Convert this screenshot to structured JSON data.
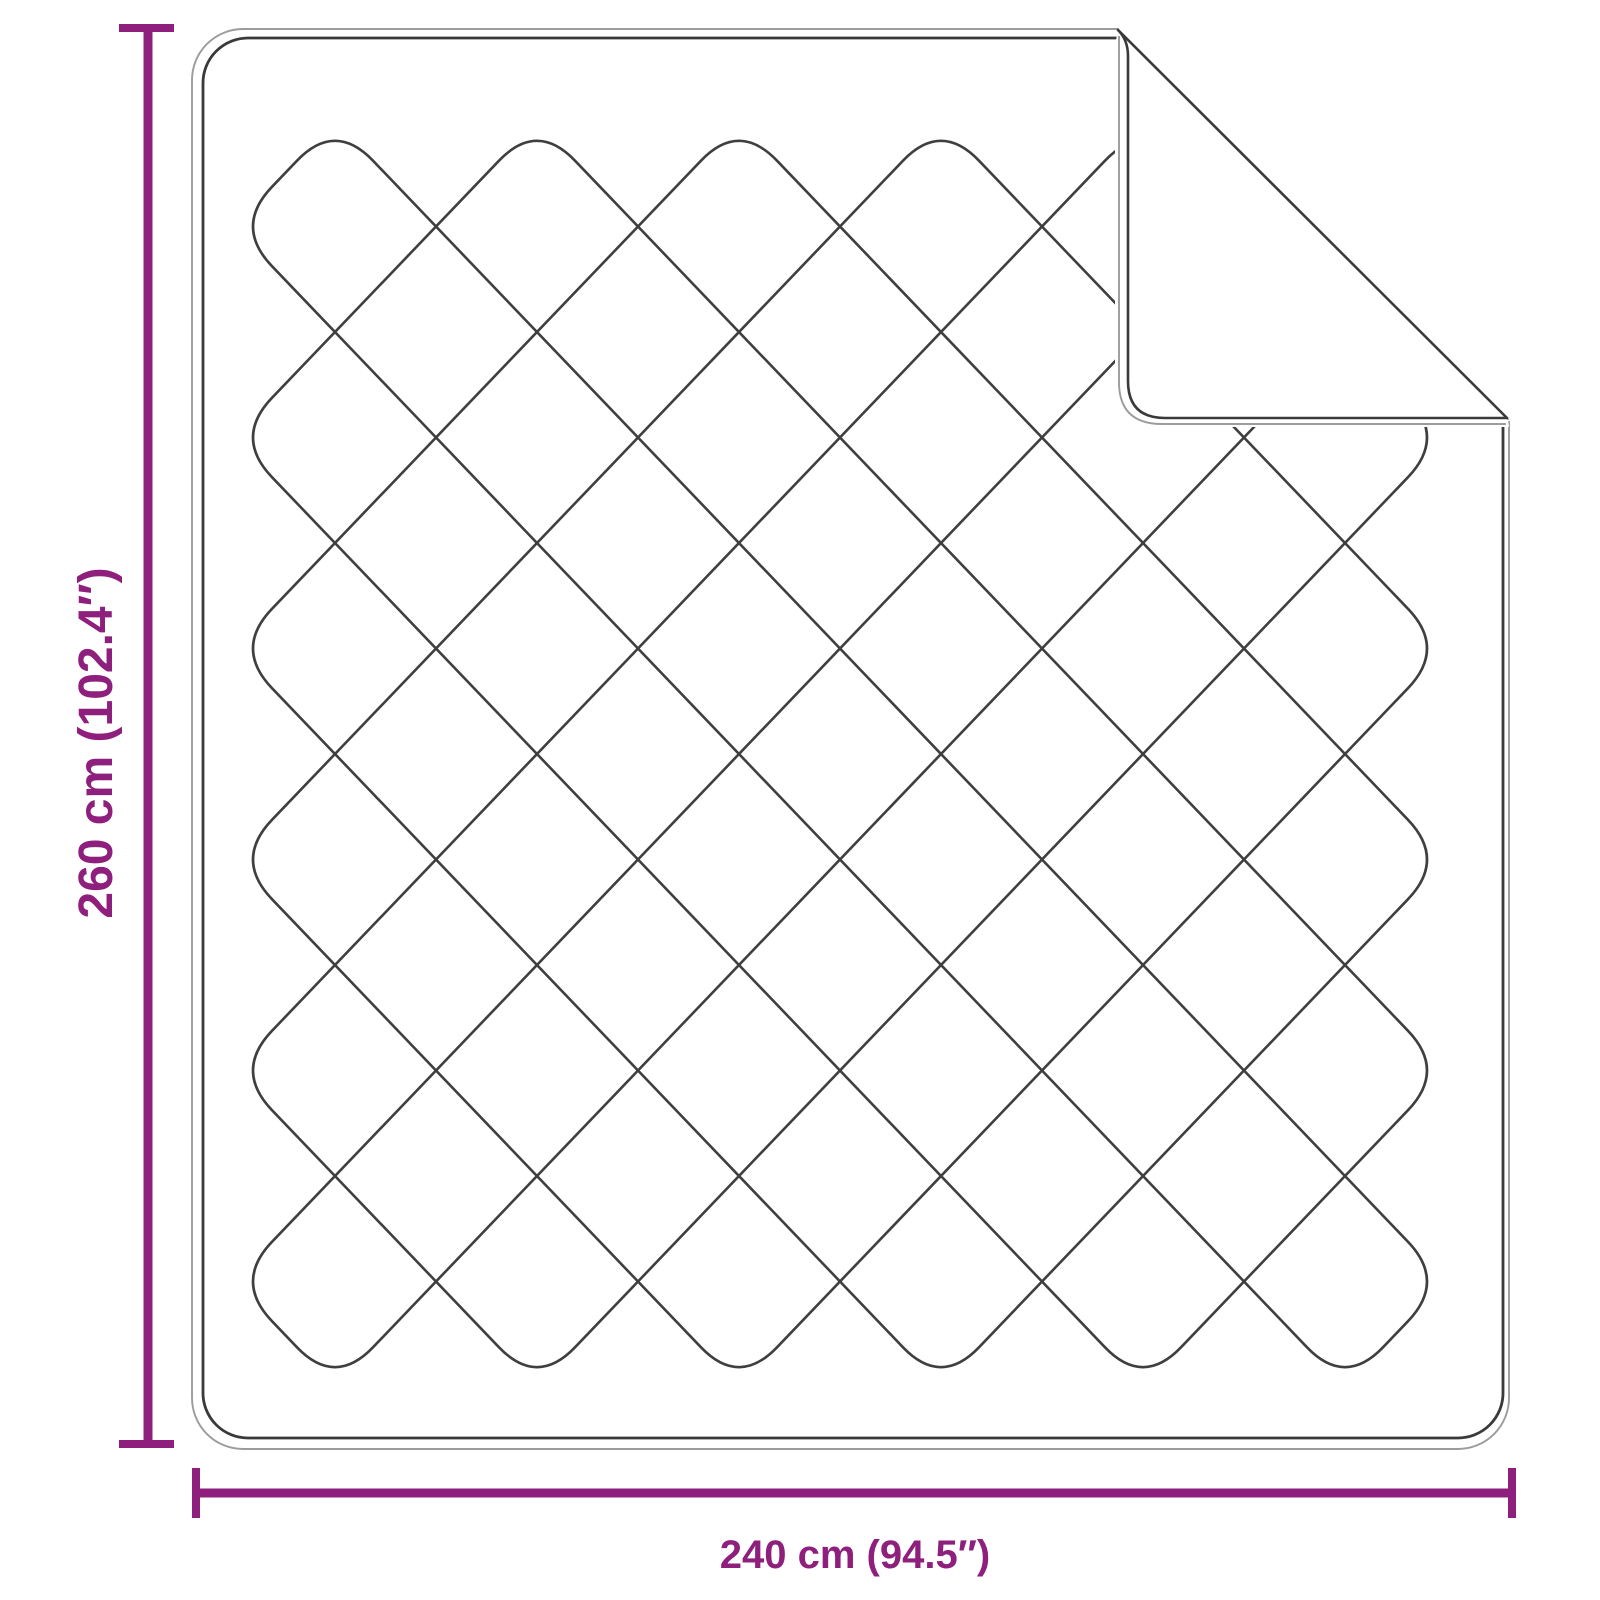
{
  "diagram": {
    "type": "product-dimension-diagram",
    "subject": "quilted blanket with folded corner",
    "height_label": "260 cm (102.4″)",
    "width_label": "240 cm (94.5″)",
    "height_cm": 260,
    "height_in": 102.4,
    "width_cm": 240,
    "width_in": 94.5
  },
  "colors": {
    "dimension": "#8E1F7D",
    "line_dark": "#3A3A3A",
    "line_light": "#9C9C9C",
    "quilt": "#3F3F3F",
    "background": "#FFFFFF"
  }
}
